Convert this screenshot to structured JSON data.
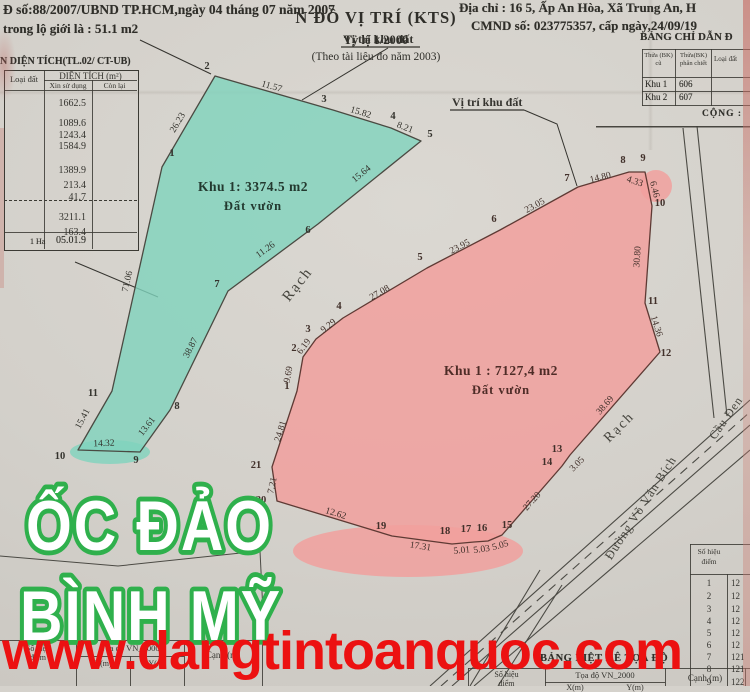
{
  "header": {
    "left_line1": "Đ số:88/2007/UBND TP.HCM,ngày 04 tháng 07 năm 2007",
    "left_line2": "trong lộ giới  là : 51.1 m2",
    "right_line1": "Địa chỉ : 16 5, Ấp An Hòa, Xã Trung An, H",
    "right_line2": "CMND số: 023775357, cấp ngày,24/09/19"
  },
  "guide_table": {
    "title": "BẢNG CHỈ DẪN Đ",
    "col_old": "Thửa (BK) cũ",
    "col_new": "Thửa(BK) phân chiết",
    "col_type": "Loại đất",
    "rows": [
      {
        "zone": "Khu 1",
        "plot": "606"
      },
      {
        "zone": "Khu 2",
        "plot": "607"
      }
    ],
    "footer": "CỘNG :"
  },
  "area_table": {
    "title": "N DIỆN TÍCH(TL.02/ CT-UB)",
    "col_land_type": "Loại đất",
    "col_area": "DIỆN TÍCH (m²)",
    "col_requested": "Xin sử dụng",
    "col_remaining": "Còn lại",
    "values": [
      "1662.5",
      "1089.6",
      "1243.4",
      "1584.9",
      "1389.9",
      "213.4",
      "41.7",
      "3211.1",
      "163.4"
    ],
    "footer_unit": "1 Ha",
    "footer_value": "05.01.9"
  },
  "points_table": {
    "header_line1": "Số hiệu",
    "header_line2": "điểm",
    "rows": [
      {
        "n": "1",
        "v": "12"
      },
      {
        "n": "2",
        "v": "12"
      },
      {
        "n": "3",
        "v": "12"
      },
      {
        "n": "4",
        "v": "12"
      },
      {
        "n": "5",
        "v": "12"
      },
      {
        "n": "6",
        "v": "12"
      },
      {
        "n": "7",
        "v": "121"
      },
      {
        "n": "8",
        "v": "121"
      },
      {
        "n": "9",
        "v": "122"
      }
    ]
  },
  "coord_table_right": {
    "title": "BẢNG LIỆT KÊ TỌA ĐỘ",
    "col_point_1": "Số hiệu",
    "col_point_2": "điểm",
    "col_coord": "Tọa độ VN_2000",
    "col_x": "X(m)",
    "col_y": "Y(m)",
    "col_edge": "Cạnh (m)"
  },
  "coord_table_left": {
    "col_point_1": "Số hiệu",
    "col_point_2": "điểm",
    "col_coord": "Tọa độ VN_2000",
    "col_x": "X(m)",
    "col_y": "Y(m)",
    "col_edge": "Cạnh (m)"
  },
  "title_box": {
    "line1": "N ĐỒ VỊ TRÍ (KTS)",
    "line2": "Tỷ lệ 1/2000",
    "line3": "(Theo tài liệu đo năm 2003)"
  },
  "overlays": {
    "brand_line1": "ỐC ĐẢO",
    "brand_line2": "BÌNH MỸ",
    "brand_color": "#2fb04c",
    "watermark": "www.dangtintoanquoc.com",
    "watermark_color": "#ec1111"
  },
  "map": {
    "ink": "#35342f",
    "location_labels": [
      {
        "text": "Vị trí khu đất",
        "x": 343,
        "y": 43,
        "underline": [
          [
            341,
            47
          ],
          [
            420,
            47
          ]
        ],
        "leader": [
          [
            388,
            48
          ],
          [
            302,
            100
          ]
        ]
      },
      {
        "text": "Vị trí khu đất",
        "x": 452,
        "y": 106,
        "underline": [
          [
            450,
            110
          ],
          [
            524,
            110
          ]
        ],
        "leader": [
          [
            524,
            110
          ],
          [
            557,
            124
          ],
          [
            577,
            186
          ]
        ]
      }
    ],
    "survey_lines": [
      [
        [
          140,
          40
        ],
        [
          211,
          74
        ]
      ],
      [
        [
          75,
          262
        ],
        [
          158,
          297
        ]
      ]
    ],
    "fragment_lines": [
      [
        [
          0,
          556
        ],
        [
          118,
          566
        ],
        [
          260,
          551
        ]
      ],
      [
        [
          260,
          551
        ],
        [
          263,
          612
        ]
      ],
      [
        [
          596,
          127
        ],
        [
          750,
          127
        ]
      ]
    ],
    "roads": [
      {
        "pts": [
          [
            430,
            686
          ],
          [
            750,
            400
          ]
        ]
      },
      {
        "pts": [
          [
            452,
            686
          ],
          [
            750,
            425
          ]
        ]
      },
      {
        "pts": [
          [
            474,
            686
          ],
          [
            750,
            450
          ]
        ]
      },
      {
        "pts": [
          [
            441,
            686
          ],
          [
            750,
            412
          ]
        ],
        "dash": "9 7"
      },
      {
        "pts": [
          [
            683,
            128
          ],
          [
            714,
            418
          ]
        ]
      },
      {
        "pts": [
          [
            697,
            126
          ],
          [
            727,
            416
          ]
        ]
      },
      {
        "pts": [
          [
            540,
            570
          ],
          [
            470,
            686
          ]
        ]
      },
      {
        "pts": [
          [
            562,
            585
          ],
          [
            498,
            686
          ]
        ]
      }
    ],
    "text_labels": [
      {
        "text": "Rạch",
        "x": 301,
        "y": 287,
        "r": -52,
        "size": 15,
        "ls": 2
      },
      {
        "text": "Rạch",
        "x": 622,
        "y": 430,
        "r": -45,
        "size": 14,
        "ls": 2
      },
      {
        "text": "Đường Võ Văn Bích",
        "x": 644,
        "y": 510,
        "r": -57,
        "size": 12.5,
        "ls": 1
      },
      {
        "text": "Cầu Đen",
        "x": 729,
        "y": 420,
        "r": -55,
        "size": 12,
        "ls": 1
      },
      {
        "text": "NE",
        "x": 219,
        "y": 629,
        "r": 0,
        "size": 14,
        "ls": 5
      }
    ],
    "green_parcel": {
      "name": "green-parcel",
      "area_label": "Khu 1: 3374.5 m2",
      "land_use": "Đất vườn",
      "fill": "#7fd3bd",
      "opacity": 0.8,
      "stroke": "#4a4a42",
      "ink": "#34332d",
      "label_ink": "#23392f",
      "label_x": 253,
      "label_y": 191,
      "blobs": [
        [
          110,
          452,
          40,
          12
        ]
      ],
      "vertices": [
        {
          "n": "1",
          "x": 162,
          "y": 167,
          "lx": 172,
          "ly": 156
        },
        {
          "n": "2",
          "x": 215,
          "y": 76,
          "lx": 207,
          "ly": 69
        },
        {
          "n": "3",
          "x": 333,
          "y": 110,
          "lx": 324,
          "ly": 102
        },
        {
          "n": "4",
          "x": 391,
          "y": 128,
          "lx": 393,
          "ly": 119
        },
        {
          "n": "5",
          "x": 421,
          "y": 141,
          "lx": 430,
          "ly": 137
        },
        {
          "n": "6",
          "x": 318,
          "y": 224,
          "lx": 308,
          "ly": 233
        },
        {
          "n": "7",
          "x": 228,
          "y": 291,
          "lx": 217,
          "ly": 287
        },
        {
          "n": "8",
          "x": 170,
          "y": 410,
          "lx": 177,
          "ly": 409
        },
        {
          "n": "9",
          "x": 140,
          "y": 452,
          "lx": 136,
          "ly": 463
        },
        {
          "n": "10",
          "x": 78,
          "y": 450,
          "lx": 60,
          "ly": 459
        },
        {
          "n": "11",
          "x": 112,
          "y": 391,
          "lx": 93,
          "ly": 396
        }
      ],
      "edges": [
        {
          "len": "26.23",
          "x": 180,
          "y": 124,
          "r": -59
        },
        {
          "len": "11.57",
          "x": 271,
          "y": 89,
          "r": 16
        },
        {
          "len": "15.82",
          "x": 360,
          "y": 115,
          "r": 17
        },
        {
          "len": "8.21",
          "x": 404,
          "y": 130,
          "r": 21
        },
        {
          "len": "15.64",
          "x": 363,
          "y": 176,
          "r": -39
        },
        {
          "len": "11.26",
          "x": 267,
          "y": 252,
          "r": -36
        },
        {
          "len": "38.87",
          "x": 193,
          "y": 349,
          "r": -63
        },
        {
          "len": "13.61",
          "x": 149,
          "y": 428,
          "r": -52
        },
        {
          "len": "14.32",
          "x": 104,
          "y": 446,
          "r": -2
        },
        {
          "len": "15.41",
          "x": 85,
          "y": 420,
          "r": -62
        },
        {
          "len": "71.06",
          "x": 130,
          "y": 282,
          "r": -77
        }
      ]
    },
    "pink_parcel": {
      "name": "pink-parcel",
      "area_label": "Khu 1 : 7127,4 m2",
      "land_use": "Đất vườn",
      "fill": "#f1a09d",
      "opacity": 0.85,
      "stroke": "#5e3a34",
      "ink": "#41302a",
      "label_ink": "#4e2c27",
      "label_x": 501,
      "label_y": 375,
      "blobs": [
        [
          656,
          186,
          16,
          16
        ],
        [
          408,
          551,
          115,
          26
        ]
      ],
      "vertices": [
        {
          "n": "1",
          "x": 297,
          "y": 391,
          "lx": 287,
          "ly": 389
        },
        {
          "n": "2",
          "x": 303,
          "y": 357,
          "lx": 294,
          "ly": 351
        },
        {
          "n": "3",
          "x": 316,
          "y": 339,
          "lx": 308,
          "ly": 332
        },
        {
          "n": "4",
          "x": 343,
          "y": 318,
          "lx": 339,
          "ly": 309
        },
        {
          "n": "5",
          "x": 427,
          "y": 268,
          "lx": 420,
          "ly": 260
        },
        {
          "n": "6",
          "x": 500,
          "y": 230,
          "lx": 494,
          "ly": 222
        },
        {
          "n": "7",
          "x": 578,
          "y": 187,
          "lx": 567,
          "ly": 181
        },
        {
          "n": "8",
          "x": 629,
          "y": 172,
          "lx": 623,
          "ly": 163
        },
        {
          "n": "9",
          "x": 645,
          "y": 172,
          "lx": 643,
          "ly": 161
        },
        {
          "n": "10",
          "x": 652,
          "y": 206,
          "lx": 660,
          "ly": 206
        },
        {
          "n": "11",
          "x": 645,
          "y": 303,
          "lx": 653,
          "ly": 304
        },
        {
          "n": "12",
          "x": 660,
          "y": 352,
          "lx": 666,
          "ly": 356
        },
        {
          "n": "13",
          "x": 570,
          "y": 455,
          "lx": 557,
          "ly": 452
        },
        {
          "n": "14",
          "x": 562,
          "y": 466,
          "lx": 547,
          "ly": 465
        },
        {
          "n": "15",
          "x": 502,
          "y": 535,
          "lx": 507,
          "ly": 528
        },
        {
          "n": "16",
          "x": 488,
          "y": 541,
          "lx": 482,
          "ly": 531
        },
        {
          "n": "17",
          "x": 474,
          "y": 542,
          "lx": 466,
          "ly": 532
        },
        {
          "n": "18",
          "x": 452,
          "y": 544,
          "lx": 445,
          "ly": 534
        },
        {
          "n": "19",
          "x": 392,
          "y": 536,
          "lx": 381,
          "ly": 529
        },
        {
          "n": "20",
          "x": 277,
          "y": 501,
          "lx": 261,
          "ly": 503
        },
        {
          "n": "21",
          "x": 272,
          "y": 467,
          "lx": 256,
          "ly": 468
        }
      ],
      "edges": [
        {
          "len": "9.69",
          "x": 291,
          "y": 375,
          "r": -80
        },
        {
          "len": "6.19",
          "x": 306,
          "y": 348,
          "r": -54
        },
        {
          "len": "9.29",
          "x": 330,
          "y": 328,
          "r": -38
        },
        {
          "len": "27.08",
          "x": 381,
          "y": 295,
          "r": -30
        },
        {
          "len": "23.95",
          "x": 461,
          "y": 249,
          "r": -27
        },
        {
          "len": "23.05",
          "x": 536,
          "y": 208,
          "r": -29
        },
        {
          "len": "14.80",
          "x": 601,
          "y": 180,
          "r": -14
        },
        {
          "len": "4.33",
          "x": 634,
          "y": 184,
          "r": 18
        },
        {
          "len": "6.46",
          "x": 652,
          "y": 190,
          "r": 76
        },
        {
          "len": "30.80",
          "x": 640,
          "y": 257,
          "r": -86
        },
        {
          "len": "14.36",
          "x": 654,
          "y": 327,
          "r": 72
        },
        {
          "len": "38.69",
          "x": 607,
          "y": 407,
          "r": -49
        },
        {
          "len": "3.05",
          "x": 579,
          "y": 466,
          "r": -45
        },
        {
          "len": "27.20",
          "x": 534,
          "y": 503,
          "r": -48
        },
        {
          "len": "5.05",
          "x": 501,
          "y": 548,
          "r": -16
        },
        {
          "len": "5.03",
          "x": 482,
          "y": 552,
          "r": -8
        },
        {
          "len": "5.01",
          "x": 462,
          "y": 553,
          "r": -6
        },
        {
          "len": "17.31",
          "x": 420,
          "y": 549,
          "r": 9
        },
        {
          "len": "12.62",
          "x": 335,
          "y": 516,
          "r": 17
        },
        {
          "len": "7.21",
          "x": 275,
          "y": 486,
          "r": -78
        },
        {
          "len": "24.81",
          "x": 283,
          "y": 432,
          "r": -73
        }
      ]
    }
  }
}
